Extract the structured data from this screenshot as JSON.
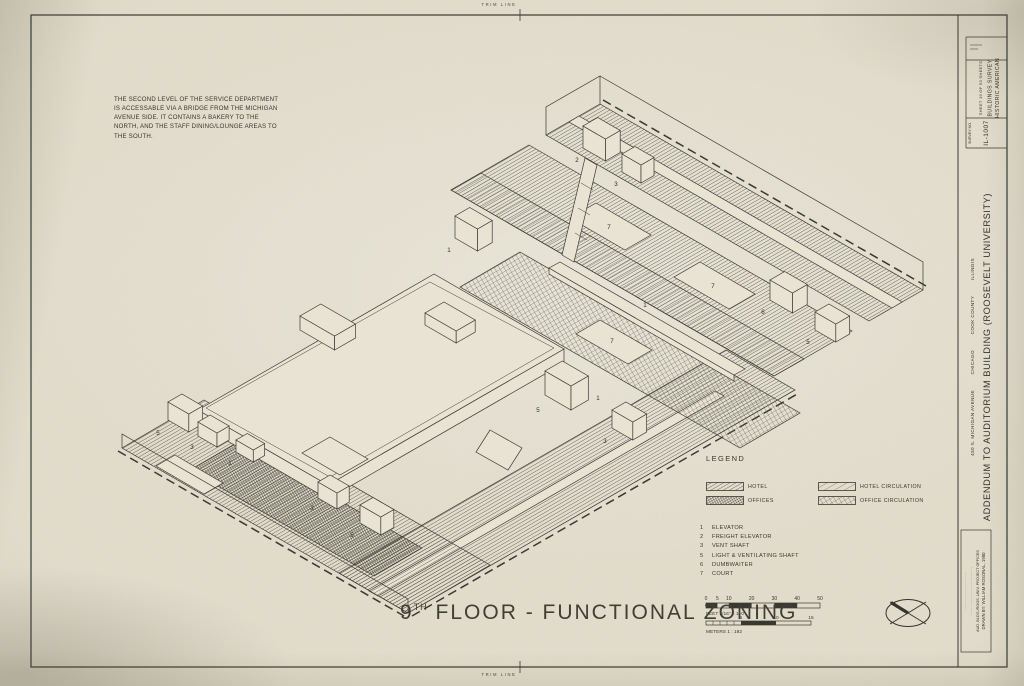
{
  "colors": {
    "paper": "#e3decd",
    "ink": "#35342c"
  },
  "trim": {
    "top": "TRIM LINE",
    "bottom": "TRIM LINE"
  },
  "note": {
    "lines": [
      "THE SECOND LEVEL OF THE SERVICE DEPARTMENT",
      "IS ACCESSABLE VIA A BRIDGE FROM THE MICHIGAN",
      "AVENUE SIDE. IT CONTAINS A BAKERY TO THE",
      "NORTH, AND THE STAFF DINING/LOUNGE AREAS TO",
      "THE SOUTH."
    ]
  },
  "legend": {
    "title": "LEGEND",
    "items": [
      {
        "label": "HOTEL"
      },
      {
        "label": "OFFICES"
      },
      {
        "label": "HOTEL CIRCULATION"
      },
      {
        "label": "OFFICE CIRCULATION"
      }
    ]
  },
  "key": {
    "items": [
      {
        "num": "1",
        "label": "ELEVATOR"
      },
      {
        "num": "2",
        "label": "FREIGHT ELEVATOR"
      },
      {
        "num": "3",
        "label": "VENT SHAFT"
      },
      {
        "num": "5",
        "label": "LIGHT & VENTILATING SHAFT"
      },
      {
        "num": "6",
        "label": "DUMBWAITER"
      },
      {
        "num": "7",
        "label": "COURT"
      }
    ]
  },
  "scalebars": {
    "feet": {
      "ticks": [
        "0",
        "5",
        "10",
        "20",
        "30",
        "40",
        "50"
      ],
      "caption": "FEET   1/16\" = 1'-0\""
    },
    "meters": {
      "ticks": [
        "0",
        "5",
        "10",
        "15"
      ],
      "caption": "METERS   1 : 192"
    }
  },
  "sheet_title": {
    "num": "9",
    "sup": "TH",
    "rest": " FLOOR - FUNCTIONAL ZONING"
  },
  "titleblock": {
    "agency1": "HISTORIC AMERICAN",
    "agency2": "BUILDINGS SURVEY",
    "sheet": "SHEET 19 OF 53 SHEETS",
    "survey_label": "SURVEY NO.",
    "survey_no": "IL-1007",
    "project": "ADDENDUM TO AUDITORIUM BUILDING (ROOSEVELT UNIVERSITY)",
    "address_parts": [
      "430 S. MICHIGAN AVENUE",
      "CHICAGO",
      "COOK COUNTY",
      "ILLINOIS"
    ],
    "credit1": "DRAWN BY: WILLIAM ROSONAL, 1980",
    "credit2": "AUD. BLDG./ROOS. UNIV. PROJECT OFFICES",
    "credit3": "· · · · · · · · · · · · · · · · · · · · · · · ·",
    "credit4": "· · · · · · · · · · · · · · · · · · ·"
  },
  "drawing": {
    "labels": [
      {
        "t": "2",
        "x": 577,
        "y": 162
      },
      {
        "t": "3",
        "x": 616,
        "y": 186
      },
      {
        "t": "7",
        "x": 609,
        "y": 229
      },
      {
        "t": "7",
        "x": 713,
        "y": 288
      },
      {
        "t": "1",
        "x": 645,
        "y": 307
      },
      {
        "t": "7",
        "x": 612,
        "y": 343
      },
      {
        "t": "6",
        "x": 763,
        "y": 314
      },
      {
        "t": "5",
        "x": 808,
        "y": 344
      },
      {
        "t": "1",
        "x": 449,
        "y": 252
      },
      {
        "t": "5",
        "x": 538,
        "y": 412
      },
      {
        "t": "3",
        "x": 605,
        "y": 443
      },
      {
        "t": "1",
        "x": 598,
        "y": 400
      },
      {
        "t": "5",
        "x": 158,
        "y": 435
      },
      {
        "t": "3",
        "x": 192,
        "y": 449
      },
      {
        "t": "1",
        "x": 230,
        "y": 465
      },
      {
        "t": "3",
        "x": 312,
        "y": 510
      },
      {
        "t": "5",
        "x": 352,
        "y": 537
      }
    ]
  }
}
